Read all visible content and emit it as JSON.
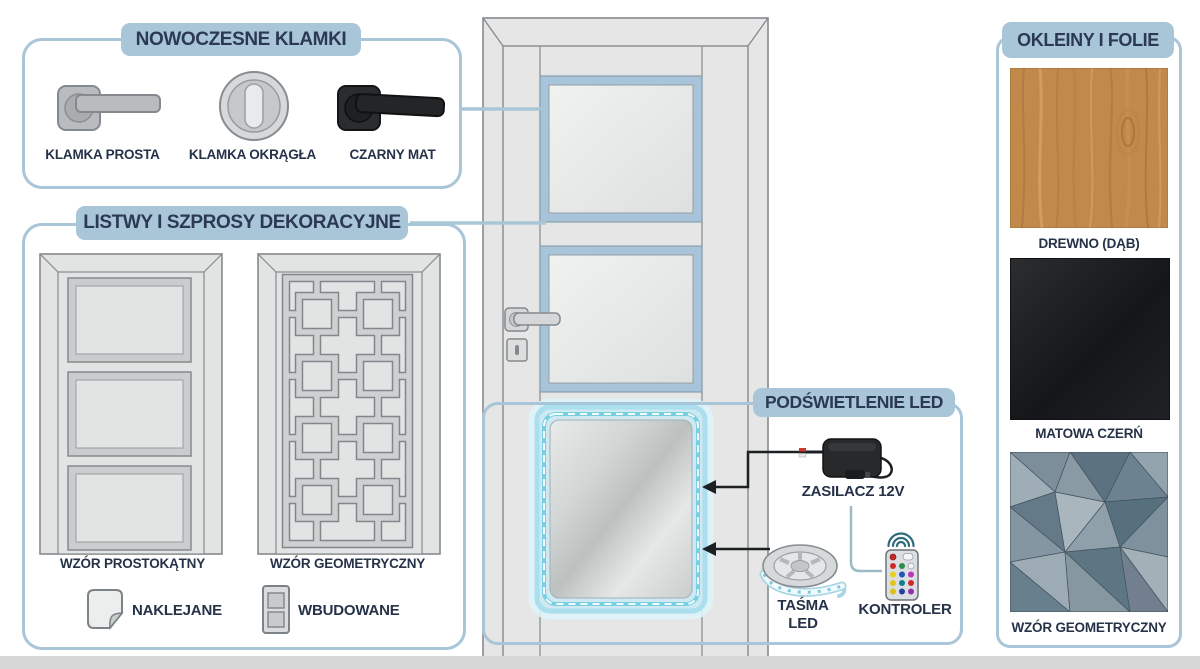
{
  "page": {
    "background": "#ffffff",
    "footer_strip_color": "#d7d7d7"
  },
  "colors": {
    "accent_blue": "#a9c5d8",
    "title_text_navy": "#2b3a52",
    "label_dark": "#263248",
    "arrow_black": "#1d2023",
    "door_fill": "#e5e6e5",
    "door_stroke": "#868a8e",
    "glass_frame_blue": "#a7c4da",
    "led_cyan_glow": "#8fd7e8",
    "oak_wood": "#c18a4b",
    "matte_black_swatch": "#1b1d1f"
  },
  "sections": {
    "handles": {
      "title": "NOWOCZESNE KLAMKI",
      "items": [
        {
          "label": "KLAMKA PROSTA",
          "icon": "lever-handle-icon"
        },
        {
          "label": "KLAMKA OKRĄGŁA",
          "icon": "round-knob-icon"
        },
        {
          "label": "CZARNY MAT",
          "icon": "black-lever-handle-icon"
        }
      ]
    },
    "moldings": {
      "title": "LISTWY I SZPROSY DEKORACYJNE",
      "items": [
        {
          "label": "WZÓR PROSTOKĄTNY",
          "icon": "rectangular-pattern-door-icon"
        },
        {
          "label": "WZÓR GEOMETRYCZNY",
          "icon": "geometric-pattern-door-icon"
        }
      ],
      "legend": [
        {
          "label": "NAKLEJANE",
          "icon": "sticker-icon"
        },
        {
          "label": "WBUDOWANE",
          "icon": "built-in-panel-icon"
        }
      ]
    },
    "led": {
      "title": "PODŚWIETLENIE LED",
      "items": [
        {
          "label": "ZASILACZ 12V",
          "icon": "power-adapter-icon"
        },
        {
          "label": "TAŚMA LED",
          "icon": "led-strip-reel-icon"
        },
        {
          "label": "KONTROLER",
          "icon": "rgb-remote-icon"
        }
      ]
    },
    "veneers": {
      "title": "OKLEINY I FOLIE",
      "items": [
        {
          "label": "DREWNO (DĄB)",
          "swatch": "oak-wood-swatch"
        },
        {
          "label": "MATOWA CZERŃ",
          "swatch": "matte-black-swatch"
        },
        {
          "label": "WZÓR GEOMETRYCZNY",
          "swatch": "geometric-pattern-swatch"
        }
      ]
    }
  }
}
